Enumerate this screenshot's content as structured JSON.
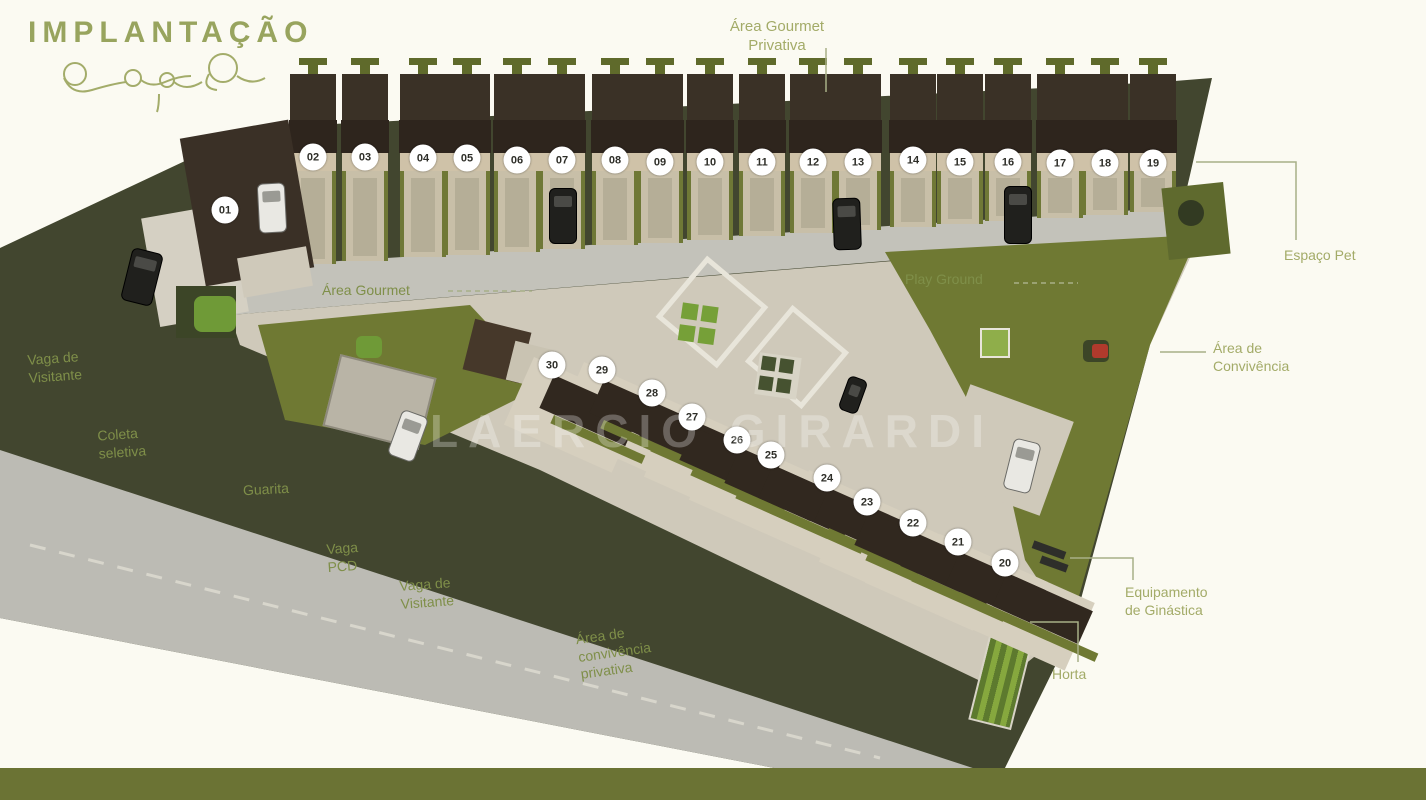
{
  "title": "IMPLANTAÇÃO",
  "watermark": "LAERCIO GIRARDI",
  "labels": {
    "area_gourmet_privativa": "Área Gourmet\nPrivativa",
    "espaco_pet": "Espaço Pet",
    "area_convivencia": "Área de\nConvivência",
    "equipamento_ginastica": "Equipamento\nde Ginástica",
    "horta": "Horta",
    "play_ground": "Play Ground",
    "area_gourmet": "Área Gourmet",
    "vaga_visitante_1": "Vaga de\nVisitante",
    "coleta_seletiva": "Coleta\nseletiva",
    "guarita": "Guarita",
    "vaga_pcd": "Vaga\nPCD",
    "vaga_visitante_2": "Vaga de\nVisitante",
    "area_convivencia_privativa": "Área de\nconvivência\nprivativa"
  },
  "units": {
    "row_top": [
      "01",
      "02",
      "03",
      "04",
      "05",
      "06",
      "07",
      "08",
      "09",
      "10",
      "11",
      "12",
      "13",
      "14",
      "15",
      "16",
      "17",
      "18",
      "19"
    ],
    "row_bottom": [
      "30",
      "29",
      "28",
      "27",
      "26",
      "25",
      "24",
      "23",
      "22",
      "21",
      "20"
    ]
  },
  "colors": {
    "title_green": "#98a45e",
    "label_green_light": "#a3ab68",
    "label_green_dark": "#7f8f49",
    "terrain_dark_olive": "#42462f",
    "lawn_olive": "#6f7933",
    "street_gray": "#bcbbb4",
    "pavement": "#cfc9ba",
    "house_beige": "#cfc2a8",
    "roof_brown": "#2e251d",
    "bottom_bar": "#6b7334",
    "play_red": "#b13a2c"
  }
}
